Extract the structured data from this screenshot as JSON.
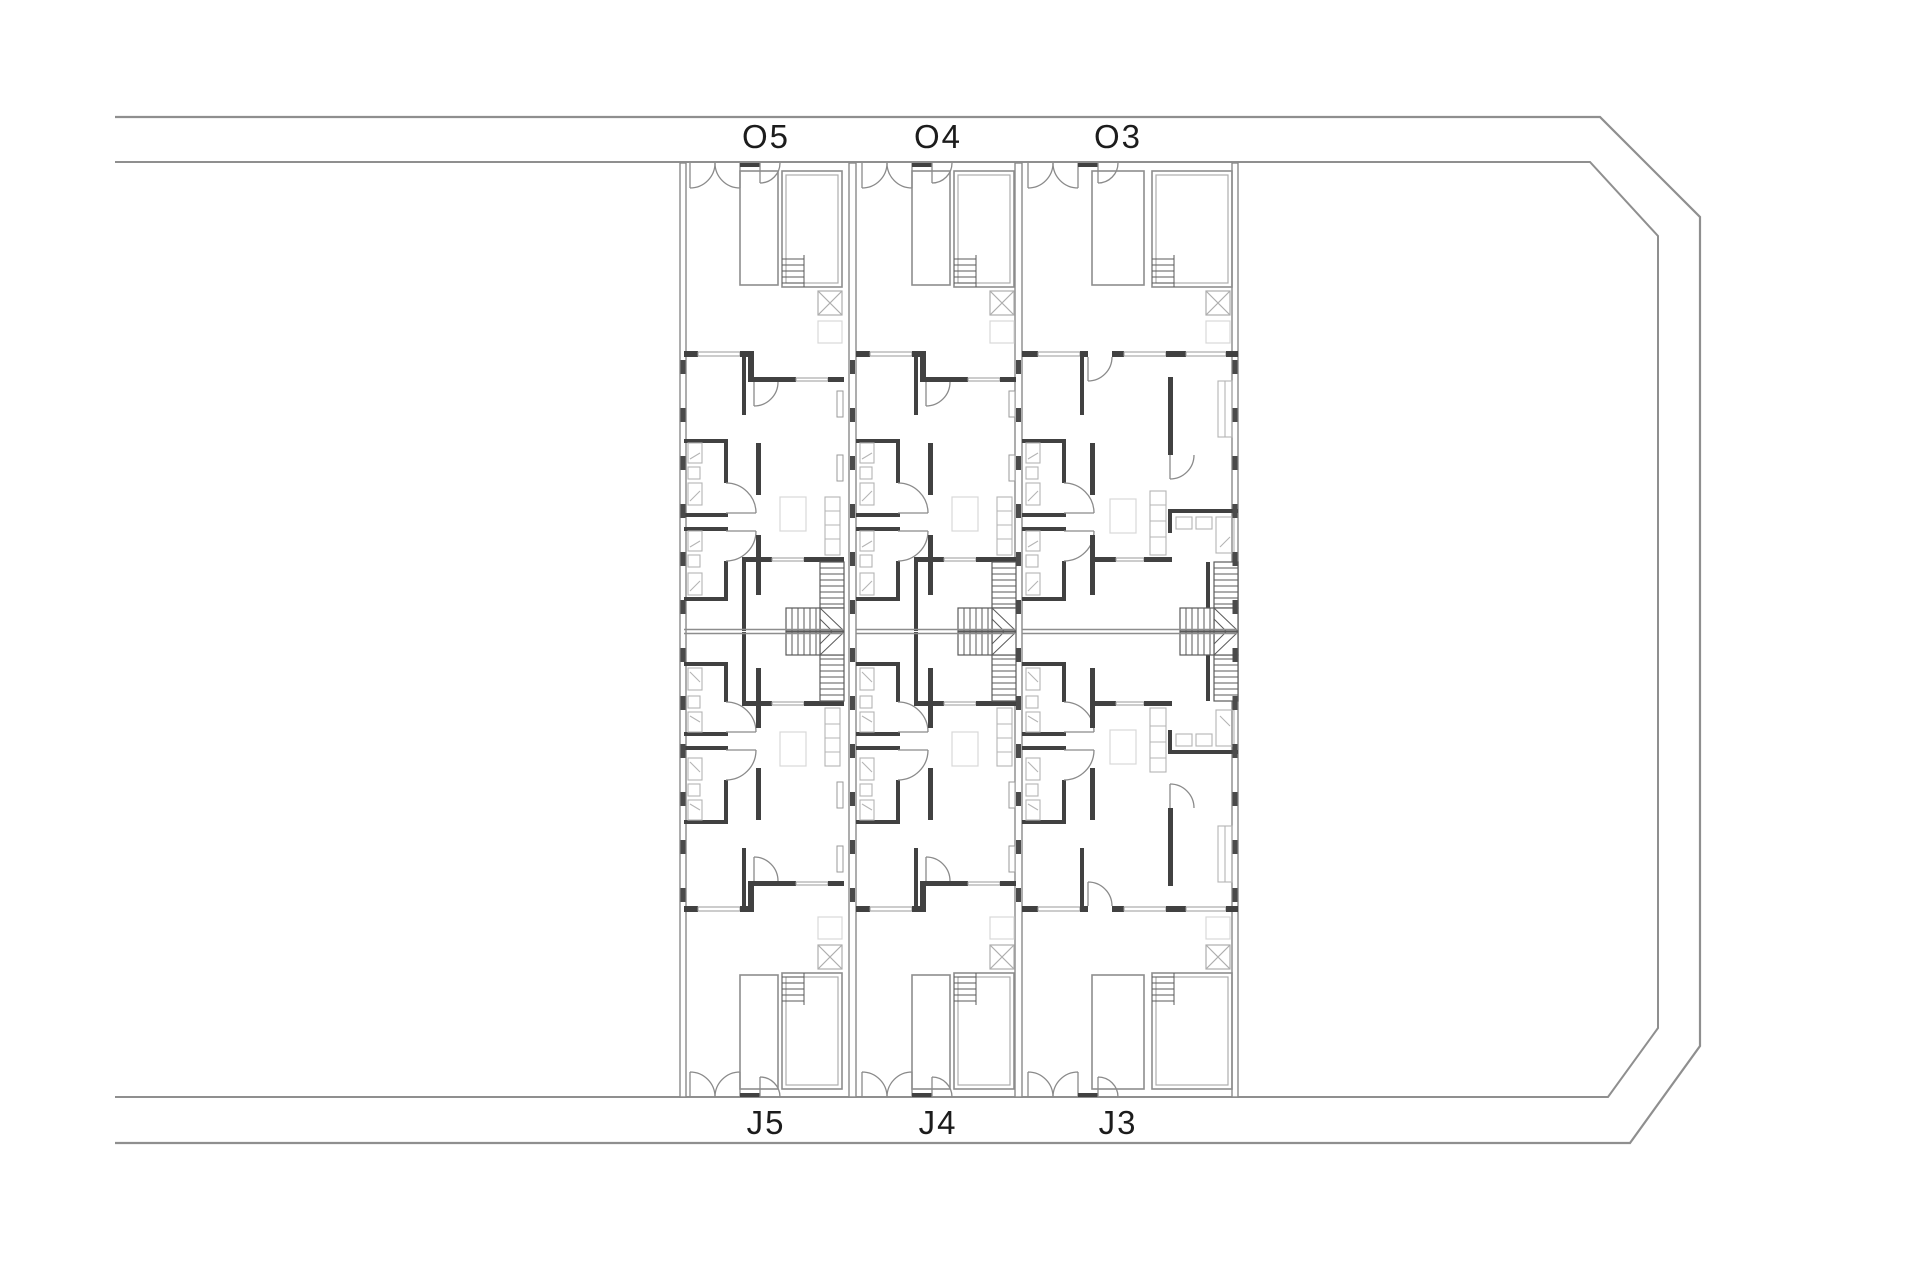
{
  "canvas": {
    "width": 1920,
    "height": 1280,
    "background": "#ffffff"
  },
  "colors": {
    "boundary": "#8f8f8f",
    "wall_dark": "#414141",
    "wall_light": "#8d8d8d",
    "fixture": "#b4b4b4",
    "faint": "#d8d8d8",
    "stairs": "#5a5a5a",
    "label_text": "#1c1c1c"
  },
  "site": {
    "boundary_shape": "double parallel boundary band, open at left edge, chamfered corners at top-right and bottom-right"
  },
  "building": {
    "columns": 3,
    "rows": [
      {
        "side": "top",
        "units": [
          {
            "id": "O5",
            "label": "O5"
          },
          {
            "id": "O4",
            "label": "O4"
          },
          {
            "id": "O3",
            "label": "O3"
          }
        ]
      },
      {
        "side": "bottom",
        "units": [
          {
            "id": "J5",
            "label": "J5"
          },
          {
            "id": "J4",
            "label": "J4"
          },
          {
            "id": "J3",
            "label": "J3"
          }
        ]
      }
    ],
    "symbols": [
      "door-swing",
      "double-gate",
      "pool",
      "pool-steps",
      "skylight-cross",
      "staircase",
      "winder-stairs",
      "bathroom-fixtures",
      "kitchen-counter",
      "table",
      "closet",
      "window-opening"
    ]
  }
}
